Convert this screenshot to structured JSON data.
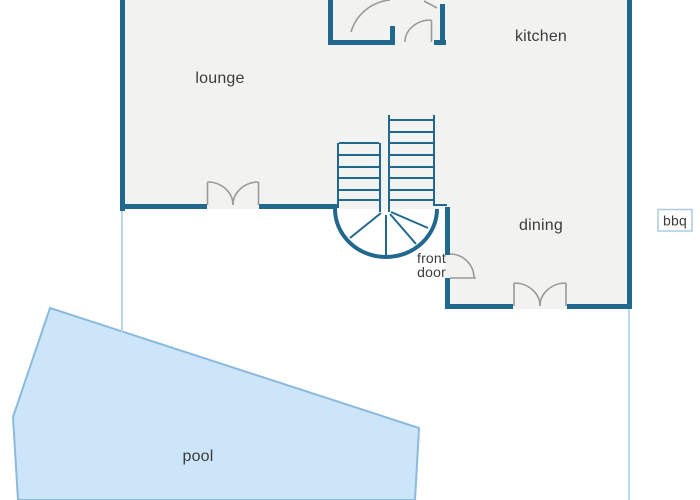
{
  "labels": {
    "lounge": "lounge",
    "kitchen": "kitchen",
    "dining": "dining",
    "front_door_line1": "front",
    "front_door_line2": "door",
    "pool": "pool",
    "bbq": "bbq"
  },
  "colors": {
    "wall": "#21688f",
    "stair_line": "#21688f",
    "house_fill": "#f2f2f0",
    "door_arc": "#9a9a9a",
    "pool_fill": "#cde5f8",
    "pool_border": "#8abade",
    "boundary_line": "#b9d6ea",
    "bbq_box_border": "#a9cce4",
    "bbq_box_fill": "#ffffff",
    "text": "#3c3c3c",
    "background": "#ffffff"
  }
}
